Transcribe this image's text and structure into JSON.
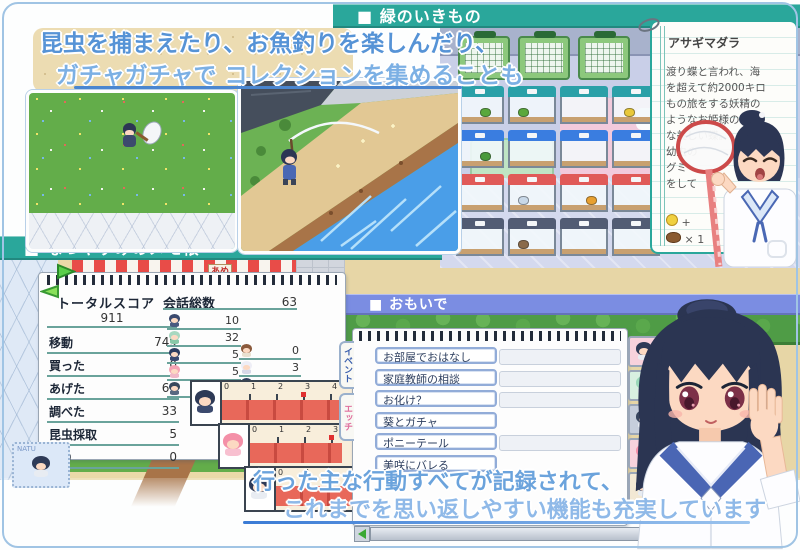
{
  "colors": {
    "teal": "#2aa79b",
    "periwinkle": "#7b8de2",
    "caption_blue": "#5693d6",
    "caption_blue_light": "#7cb0e4",
    "underline_blue": "#4a86d0",
    "gauge_red": "#e8685a"
  },
  "top_caption": {
    "line1": "昆虫を捕まえたり、お魚釣りを楽しんだり、",
    "line2": "ガチャガチャで コレクションを集めることも"
  },
  "headers": {
    "green_creatures": "■ 緑のいきもの",
    "memo_pad": "■ なつやすみのメモ帳",
    "memories": "■ おもいで"
  },
  "encyclopedia": {
    "title": "アサギマダラ",
    "description_lines": [
      "渡り蝶と言われ、海",
      "を超えて約2000キロ",
      "もの旅をする妖精の",
      "ようなお姫様のよう",
      "な美しい蝶。",
      "幼虫の",
      "グミ",
      "をして"
    ],
    "reward_coin_text": "+",
    "reward_item_text": "×  1"
  },
  "memo": {
    "total_label": "トータルスコア",
    "total_value": "911",
    "stat_rows": [
      {
        "label": "移動",
        "value": "749"
      },
      {
        "label": "買った",
        "value": "0"
      },
      {
        "label": "あげた",
        "value": "61"
      },
      {
        "label": "調べた",
        "value": "33"
      },
      {
        "label": "昆虫採取",
        "value": "5"
      },
      {
        "label": "釣り",
        "value": "0"
      }
    ],
    "talk_label": "会話総数",
    "talk_total": "63",
    "talk_left": [
      {
        "hair": "#3a4a6e",
        "dress": "#4a5a80",
        "value": "10"
      },
      {
        "hair": "#a8d8c0",
        "dress": "#88c8a8",
        "value": "32"
      },
      {
        "hair": "#2e3e62",
        "dress": "#3a4a72",
        "value": "5"
      },
      {
        "hair": "#f4a2b4",
        "dress": "#f0b8c8",
        "value": "5"
      },
      {
        "hair": "#38485c",
        "dress": "#586880",
        "value": "8"
      }
    ],
    "talk_right": [
      {
        "hair": "#8b5a3c",
        "dress": "#e8e0d0",
        "value": "0"
      },
      {
        "hair": "#eeeef6",
        "dress": "#d8d8e8",
        "value": "3"
      },
      {
        "hair": "#323f5e",
        "dress": "#44507a",
        "value": "0"
      }
    ]
  },
  "gauges": [
    {
      "hair": "#2e3a57",
      "dress": "#3c4a6e",
      "ticks": [
        "0",
        "1",
        "2",
        "3",
        "4",
        "5",
        "6"
      ],
      "fill": 0.96
    },
    {
      "hair": "#f490a8",
      "dress": "#f8c0d0",
      "ticks": [
        "0",
        "1",
        "2",
        "3",
        "4",
        "5"
      ],
      "fill": 0.54
    },
    {
      "hair": "#2e3a57",
      "dress": "#e8ecf2",
      "ticks": [
        "0",
        "1"
      ],
      "fill": 0.78
    }
  ],
  "memories": {
    "tabs": [
      {
        "label": "イベント",
        "color": "#3a5fae"
      },
      {
        "label": "エッチ",
        "color": "#e0709e"
      }
    ],
    "items": [
      "お部屋でおはなし",
      "家庭教師の相談",
      "お化け？",
      "葵とガチャ",
      "ポニーテール",
      "美咲にバレる"
    ],
    "slots_visible": [
      0,
      1,
      2,
      4
    ],
    "portraits": [
      {
        "bg": "#f8d2dc",
        "hair": "#2e3a57"
      },
      {
        "bg": "#d8f0e0",
        "hair": "#9ad8b8"
      },
      {
        "bg": "#c6cedc",
        "hair": "#38455e"
      },
      {
        "bg": "#f8d2dc",
        "hair": "#f490a8"
      },
      {
        "bg": "#f2e8d4",
        "hair": "#2e3a57"
      }
    ]
  },
  "bottom_caption": {
    "line1": "行った主な行動すべてが記録されて、",
    "line2": "これまでを思い返しやすい機能も充実しています"
  },
  "player_name": "NATU",
  "stall_sign": "あめ",
  "tanks": {
    "rows": [
      {
        "lid": "#2aa0a8",
        "bugs": [
          "#5aa83c",
          "#5aa83c",
          "",
          "#e8c83a"
        ]
      },
      {
        "lid": "#3a7de0",
        "bugs": [
          "#4a9a3c",
          "",
          "",
          ""
        ]
      },
      {
        "lid": "#e05a58",
        "bugs": [
          "",
          "#c8d8e8",
          "#e8a030",
          ""
        ]
      },
      {
        "lid": "#525c74",
        "bugs": [
          "",
          "#8a6a4a",
          "",
          ""
        ]
      }
    ]
  }
}
